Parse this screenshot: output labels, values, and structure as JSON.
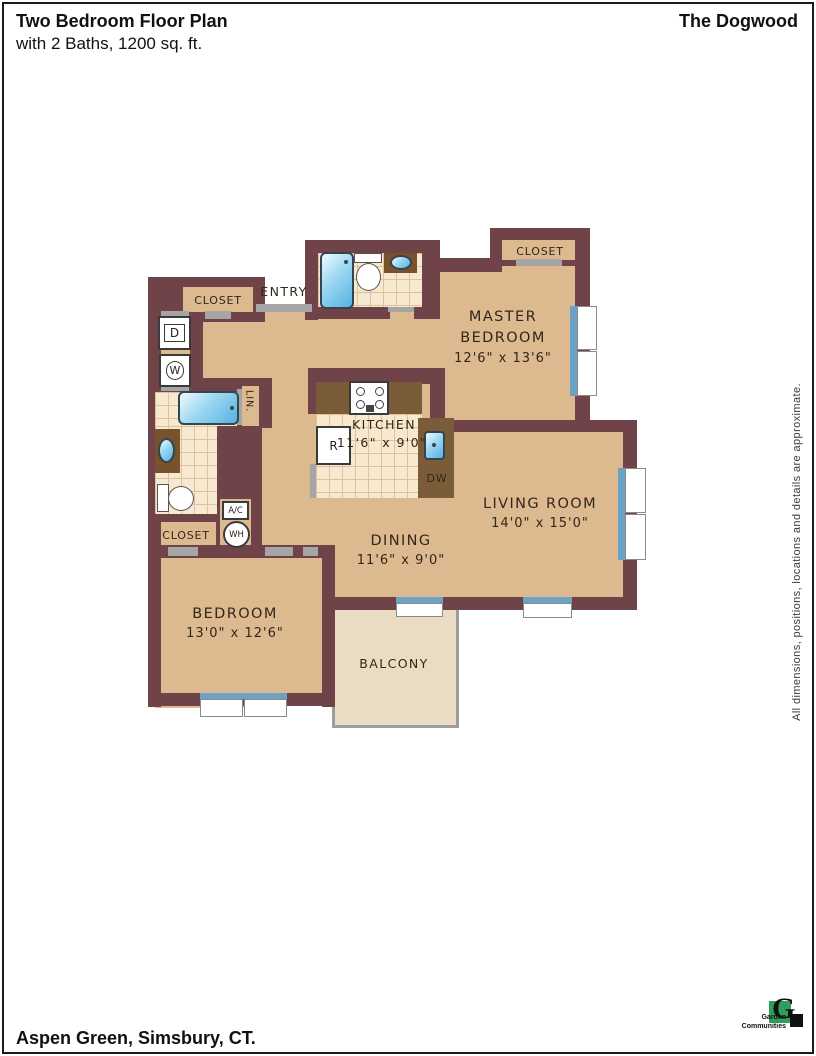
{
  "header": {
    "title": "Two Bedroom Floor Plan",
    "subtitle": "with 2 Baths, 1200 sq. ft.",
    "plan_name": "The Dogwood"
  },
  "footer": {
    "location": "Aspen Green, Simsbury, CT.",
    "logo": {
      "mark": "G",
      "name_line1": "Garden",
      "name_line2": "Communities"
    }
  },
  "disclaimer": "All dimensions, positions, locations and details are approximate.",
  "rooms": {
    "master_bedroom": {
      "line1": "MASTER",
      "line2": "BEDROOM",
      "dims": "12'6\" x 13'6\""
    },
    "living_room": {
      "name": "LIVING ROOM",
      "dims": "14'0\" x 15'0\""
    },
    "kitchen": {
      "name": "KITCHEN",
      "dims": "11'6\" x 9'0\""
    },
    "dining": {
      "name": "DINING",
      "dims": "11'6\" x 9'0\""
    },
    "bedroom": {
      "name": "BEDROOM",
      "dims": "13'0\" x 12'6\""
    },
    "balcony": {
      "name": "BALCONY"
    },
    "entry": {
      "name": "ENTRY"
    }
  },
  "labels": {
    "closet": "CLOSET",
    "linen": "LIN.",
    "dryer": "D",
    "washer": "W",
    "refrigerator": "R",
    "dishwasher": "DW",
    "air_conditioner": "A/C",
    "water_heater": "WH"
  },
  "colors": {
    "wall": "#6f4347",
    "floor_tan": "#dcb98f",
    "tile": "#f7e9cf",
    "balcony_floor": "#eadcc3",
    "counter_brown": "#77522c",
    "fixture_blue": "#58b1e0",
    "window_sill": "#6ca3c4",
    "door_gray": "#a5a5a5",
    "logo_green": "#2f9e5c"
  }
}
